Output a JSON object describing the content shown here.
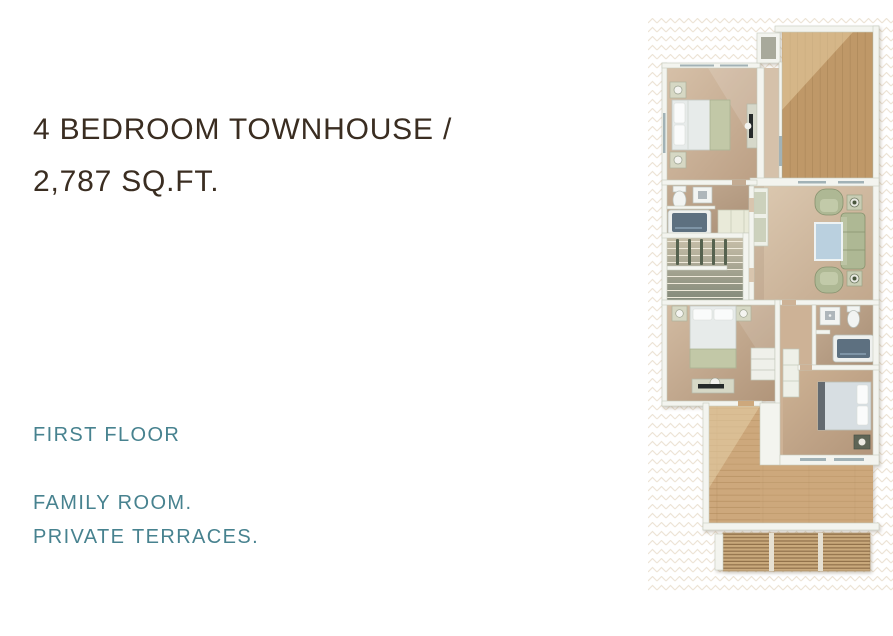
{
  "listing": {
    "title_line1": "4 BEDROOM TOWNHOUSE /",
    "title_line2": "2,787 SQ.FT.",
    "floor_label": "FIRST FLOOR",
    "features": [
      "FAMILY ROOM.",
      "PRIVATE TERRACES."
    ]
  },
  "colors": {
    "heading_text": "#3a2d21",
    "accent_teal": "#47828f",
    "page_background": "#ffffff",
    "watermark_pattern": "#ede4d6",
    "wall_white": "#f3f4ef",
    "floor_beige": "#cbb49b",
    "deck_wood": "#bf9868",
    "terrace_wood": "#cda87c",
    "upholstery_sage": "#aeb894",
    "coffee_table_glass": "#bad0df",
    "bathtub_interior": "#5d6f80"
  },
  "floorplan": {
    "type": "3d-top-down-floor-plan",
    "rooms": [
      "master-bedroom",
      "master-bathroom",
      "staircase",
      "bedroom-2",
      "family-room",
      "hallway",
      "bathroom-2",
      "bedroom-3",
      "roof-deck",
      "wood-terrace",
      "louvered-pergola"
    ]
  }
}
